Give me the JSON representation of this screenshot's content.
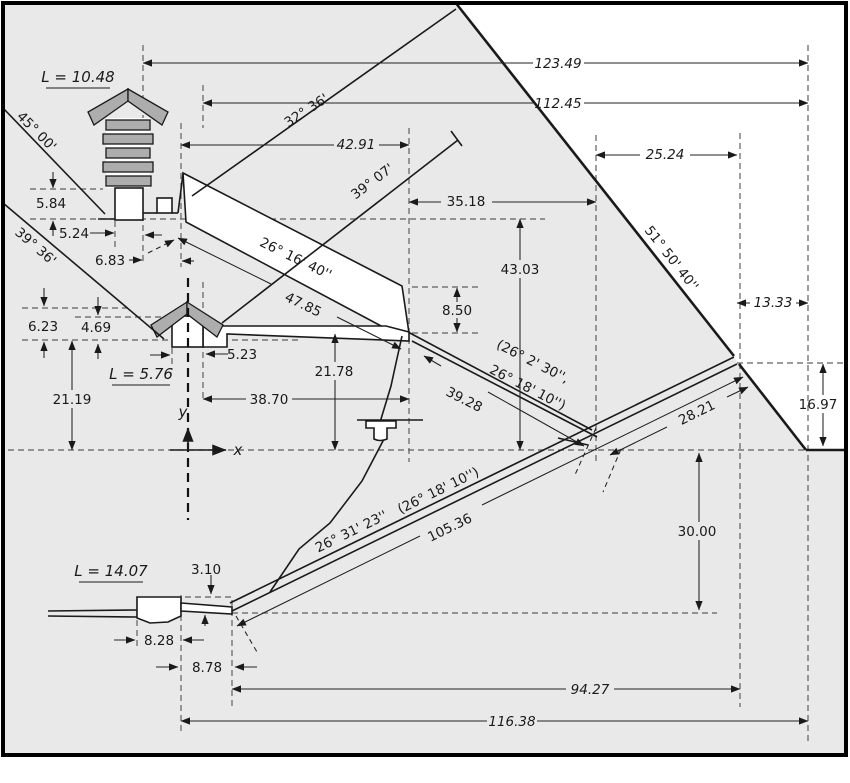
{
  "colors": {
    "background": "#e9e9e9",
    "exterior": "#ffffff",
    "line": "#1a1a1a",
    "dashed": "#5f5f5f",
    "masonry": "#adadad"
  },
  "labels": {
    "l_upper_chamber": "L = 10.48",
    "l_middle_chamber": "L = 5.76",
    "l_lower_chamber": "L = 14.07",
    "d123_49": "123.49",
    "d112_45": "112.45",
    "d25_24": "25.24",
    "d42_91": "42.91",
    "d35_18": "35.18",
    "d13_33": "13.33",
    "d43_03": "43.03",
    "d8_50": "8.50",
    "d5_84": "5.84",
    "d5_24": "5.24",
    "d6_83": "6.83",
    "d6_23": "6.23",
    "d4_69": "4.69",
    "d5_23": "5.23",
    "d21_19": "21.19",
    "d21_78": "21.78",
    "d38_70": "38.70",
    "d39_28": "39.28",
    "d47_85": "47.85",
    "d28_21": "28.21",
    "d105_36": "105.36",
    "d30_00": "30.00",
    "d16_97": "16.97",
    "d94_27": "94.27",
    "d116_38": "116.38",
    "d8_28": "8.28",
    "d8_78": "8.78",
    "d3_10": "3.10",
    "a45_00": "45° 00'",
    "a39_36": "39° 36'",
    "a32_36": "32° 36'",
    "a39_07": "39° 07'",
    "a51_50_40": "51° 50' 40''",
    "a26_16_40": "26° 16' 40''",
    "a26_31_23": "26° 31' 23''",
    "a26_18_10_paren": "(26° 18' 10'')",
    "a26_2_30_open": "(26° 2' 30'',",
    "a26_18_10_close": "26° 18' 10'')",
    "axis_x": "x",
    "axis_y": "y"
  }
}
